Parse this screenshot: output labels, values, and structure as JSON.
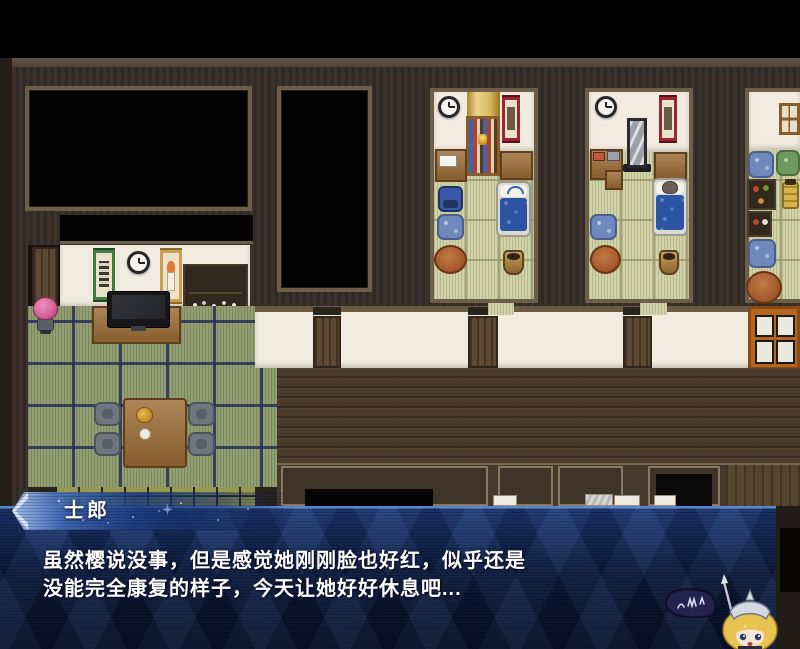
{
  "dialogue": {
    "speaker_name": "士郎",
    "lines": [
      "虽然樱说没事，但是感觉她刚刚脸也好红，似乎还是",
      "没能完全康复的样子，今天让她好好休息吧..."
    ]
  },
  "theme": {
    "box_blue_top": "#1e4084",
    "box_blue_bottom": "#07112a",
    "banner_highlight": "#a8c2ee",
    "text_color": "#ffffff",
    "tatami_green": "#8d986a",
    "tatami_beige": "#cdcfa2",
    "wood_dark": "#352d26"
  },
  "scene": {
    "mascot": "jeanne-chibi-with-flag",
    "npc": "pink-haired-character",
    "sleeping_npc": "character-in-bed"
  }
}
